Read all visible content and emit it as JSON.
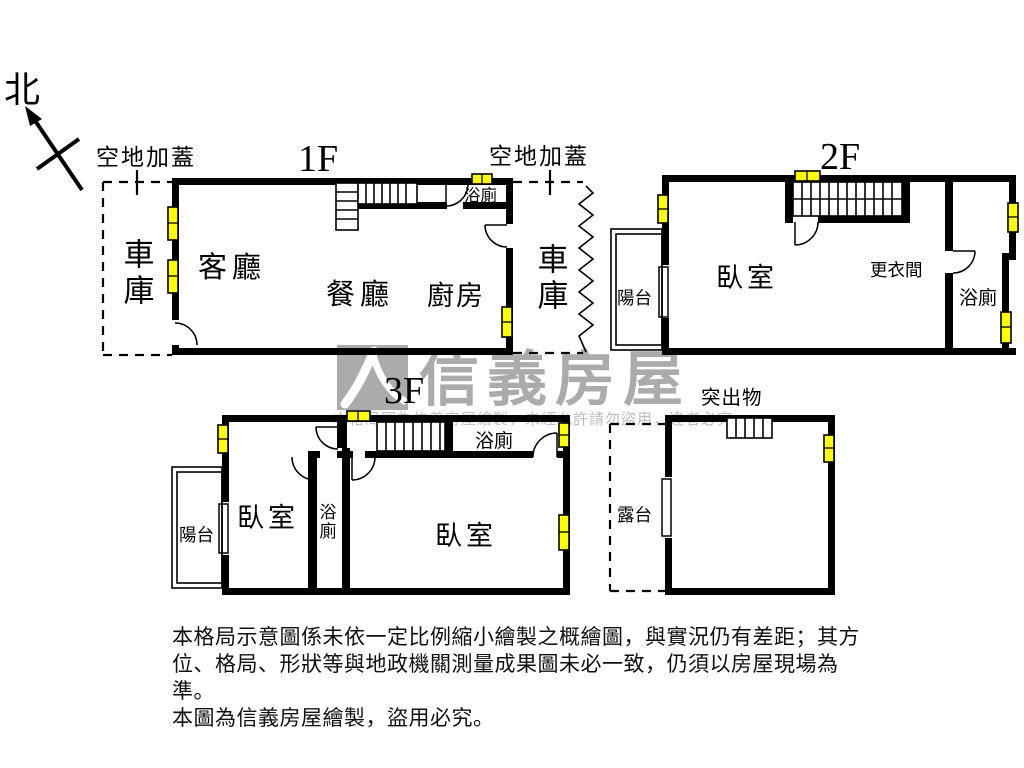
{
  "north": {
    "label": "北"
  },
  "labels": {
    "open_air_left": "空地加蓋",
    "open_air_right": "空地加蓋",
    "protrusion": "突出物"
  },
  "floor1": {
    "label": "1F",
    "rooms": {
      "garage_left": "車庫",
      "garage_right": "車庫",
      "living": "客廳",
      "dining": "餐廳",
      "kitchen": "廚房",
      "bath": "浴廁"
    }
  },
  "floor2": {
    "label": "2F",
    "rooms": {
      "balcony": "陽台",
      "bedroom": "臥室",
      "dressing": "更衣間",
      "bath": "浴廁"
    }
  },
  "floor3": {
    "label": "3F",
    "rooms": {
      "balcony": "陽台",
      "bedroom_left": "臥室",
      "bath_mid": "浴廁",
      "bedroom_right": "臥室",
      "bath_top": "浴廁"
    }
  },
  "protrusion_floor": {
    "rooms": {
      "terrace": "露台"
    }
  },
  "watermark": {
    "brand": "信義房屋",
    "notice": "本格局圖為信義房屋繪製，未經允許請勿盜用，違者必究"
  },
  "disclaimer": {
    "line1": "本格局示意圖係未依一定比例縮小繪製之概繪圖，與實況仍有差距；其方",
    "line2": "位、格局、形狀等與地政機關測量成果圖未必一致，仍須以房屋現場為準。",
    "line3": "本圖為信義房屋繪製，盜用必究。"
  },
  "colors": {
    "wall": "#000000",
    "window_fill": "#ffff00",
    "watermark_gray": "#ababab"
  }
}
